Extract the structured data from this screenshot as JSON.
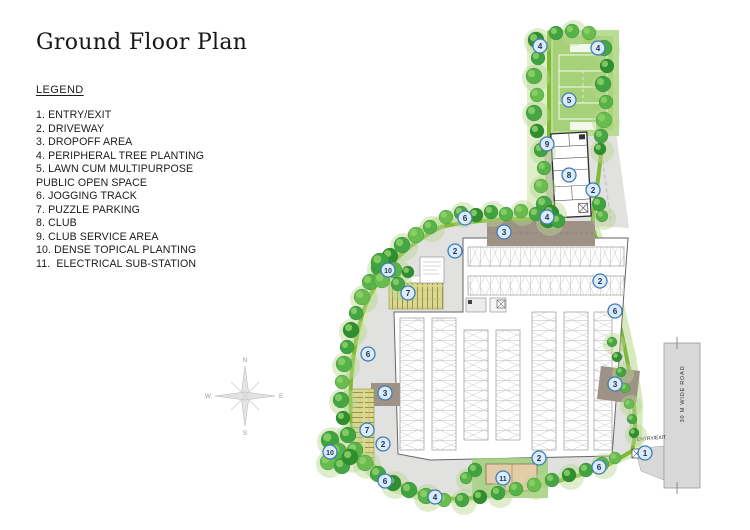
{
  "page": {
    "title": "Ground Floor Plan"
  },
  "legend": {
    "heading": "LEGEND",
    "lines": [
      "1. ENTRY/EXIT",
      "2. DRIVEWAY",
      "3. DROPOFF AREA",
      "4. PERIPHERAL TREE PLANTING",
      "5. LAWN CUM MULTIPURPOSE",
      "PUBLIC OPEN SPACE",
      "6. JOGGING TRACK",
      "7. PUZZLE PARKING",
      "8. CLUB",
      "9. CLUB SERVICE AREA",
      "10. DENSE TOPICAL PLANTING",
      "11.  ELECTRICAL SUB-STATION"
    ]
  },
  "plan": {
    "road_label": "30 M WIDE ROAD",
    "entry_label": "ENTRY/EXIT",
    "compass": {
      "n": "N",
      "s": "S",
      "e": "E",
      "w": "W"
    },
    "markers": [
      {
        "n": "4",
        "x": 540,
        "y": 46
      },
      {
        "n": "4",
        "x": 598,
        "y": 48
      },
      {
        "n": "5",
        "x": 569,
        "y": 100
      },
      {
        "n": "9",
        "x": 547,
        "y": 144
      },
      {
        "n": "8",
        "x": 569,
        "y": 175
      },
      {
        "n": "2",
        "x": 593,
        "y": 190
      },
      {
        "n": "4",
        "x": 547,
        "y": 217
      },
      {
        "n": "6",
        "x": 465,
        "y": 218
      },
      {
        "n": "3",
        "x": 504,
        "y": 232
      },
      {
        "n": "2",
        "x": 455,
        "y": 251
      },
      {
        "n": "10",
        "x": 388,
        "y": 270
      },
      {
        "n": "7",
        "x": 408,
        "y": 293
      },
      {
        "n": "2",
        "x": 600,
        "y": 281
      },
      {
        "n": "6",
        "x": 615,
        "y": 311
      },
      {
        "n": "6",
        "x": 368,
        "y": 354
      },
      {
        "n": "3",
        "x": 615,
        "y": 384
      },
      {
        "n": "3",
        "x": 385,
        "y": 393
      },
      {
        "n": "7",
        "x": 367,
        "y": 430
      },
      {
        "n": "2",
        "x": 383,
        "y": 444
      },
      {
        "n": "10",
        "x": 330,
        "y": 452
      },
      {
        "n": "6",
        "x": 385,
        "y": 481
      },
      {
        "n": "2",
        "x": 539,
        "y": 458
      },
      {
        "n": "11",
        "x": 503,
        "y": 478
      },
      {
        "n": "1",
        "x": 645,
        "y": 453
      },
      {
        "n": "6",
        "x": 599,
        "y": 467
      },
      {
        "n": "4",
        "x": 435,
        "y": 497
      }
    ],
    "colors": {
      "marker_fill": "#dcebf7",
      "marker_stroke": "#3e7cb8",
      "marker_text": "#17375c",
      "track_green": "#7ab82e",
      "lawn_green": "#a6d178",
      "tree_green": "#3fa33f",
      "driveway_gray": "#e1e1e0",
      "dropoff_brown": "#9d9285",
      "puzzle_yellow": "#ddd88f",
      "substation_tan": "#e4cda9",
      "road_gray": "#d8d8d8"
    }
  }
}
